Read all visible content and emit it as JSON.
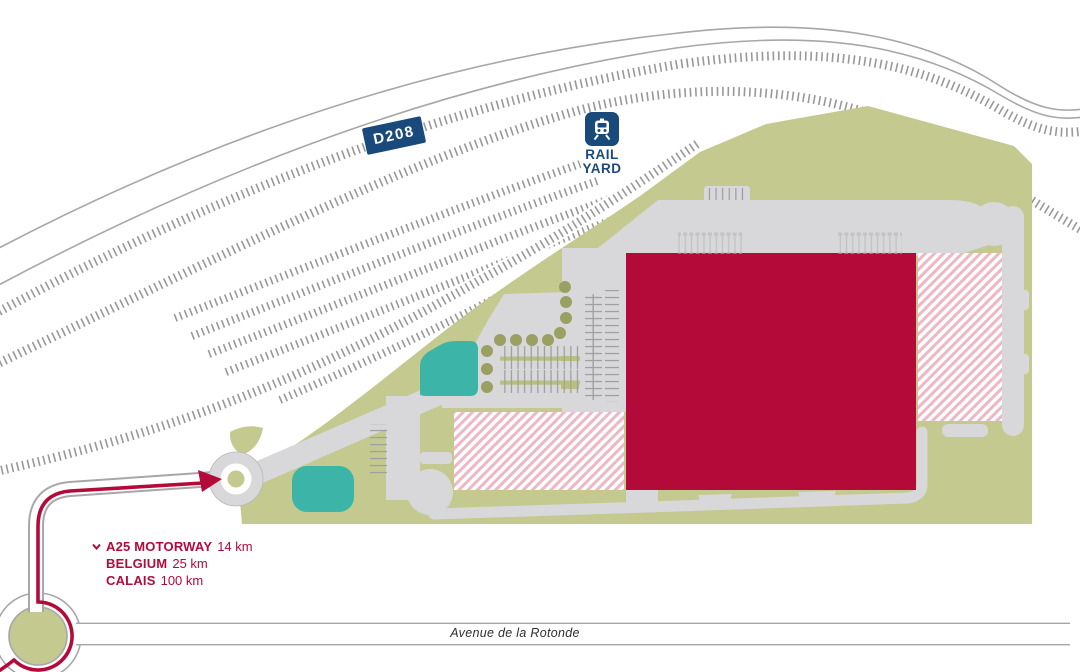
{
  "map": {
    "road_badge": "D208",
    "rail_yard_label": {
      "line1": "RAIL",
      "line2": "YARD"
    },
    "street_label": "Avenue de la Rotonde",
    "distances": [
      {
        "label": "A25 MOTORWAY",
        "value": "14 km"
      },
      {
        "label": "BELGIUM",
        "value": "25 km"
      },
      {
        "label": "CALAIS",
        "value": "100 km"
      }
    ],
    "icons": {
      "rail_yard": "train-icon",
      "route": "route-arrow-icon",
      "offmap_direction": "chevron-down-icon"
    },
    "colors": {
      "navy": "#1a4a7c",
      "crimson": "#b40a3a",
      "olive_site": "#c3c98f",
      "olive_dark": "#9aa062",
      "teal_pond": "#3cb4a8",
      "pavement": "#d8d8da",
      "hatch_pink": "#eeb7c6",
      "rail_gray": "#98989a"
    }
  }
}
